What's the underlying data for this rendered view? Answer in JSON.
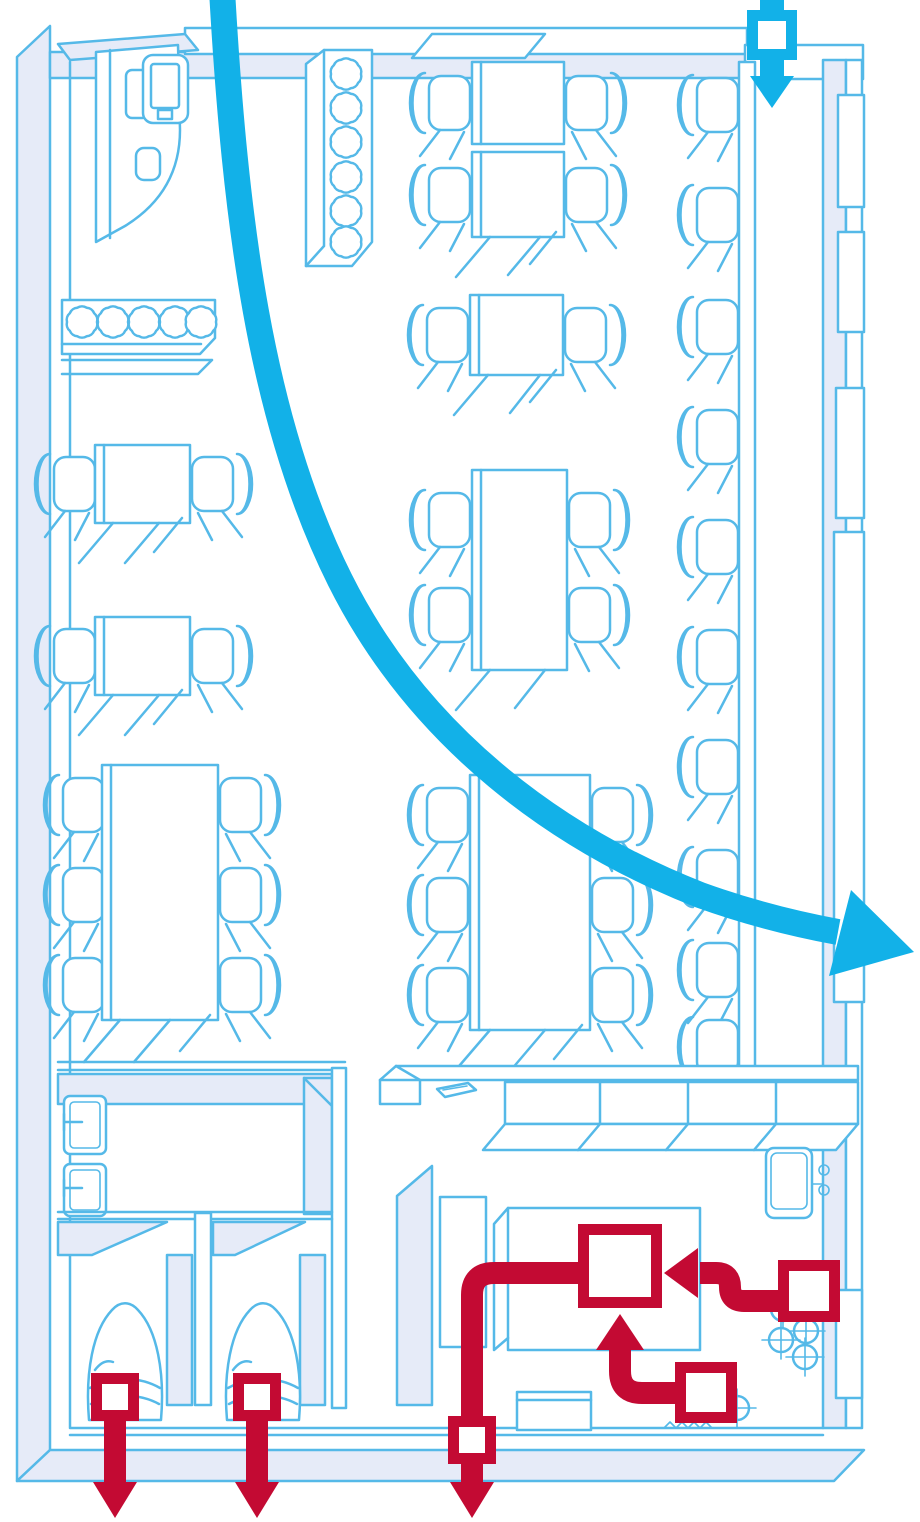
{
  "meta": {
    "title": "Isometric restaurant floor plan with entry arrow, evacuation routes and kitchen hazard marker",
    "text_content": "none — illustration only"
  },
  "colors": {
    "outline": "#55B9E8",
    "wall": "#E6EBF8",
    "flow": "#12B1E8",
    "alert": "#C30A33",
    "background": "#FFFFFF"
  },
  "legend": {
    "entry_marker": {
      "shape": "square with down arrow",
      "color_ref": "flow",
      "location": "top-right doorway"
    },
    "flow_arrow": {
      "shape": "thick curved arrow",
      "color_ref": "flow",
      "path": "from top edge curving down and right, exiting through right wall"
    },
    "hazard_marker": {
      "shape": "diagonally hatched square",
      "color_ref": "alert",
      "location": "kitchen appliance"
    },
    "exit_markers": [
      {
        "location": "left toilet stall",
        "direction": "down through bottom wall"
      },
      {
        "location": "right toilet stall",
        "direction": "down through bottom wall"
      },
      {
        "location": "kitchen corridor",
        "direction": "down through bottom wall"
      }
    ],
    "routes": [
      {
        "from": "kitchen station right",
        "to": "hazard square",
        "arrow": "left"
      },
      {
        "from": "kitchen station lower",
        "to": "hazard square",
        "arrow": "up"
      },
      {
        "from": "hazard square",
        "to": "bottom exit marker",
        "arrow": "down"
      }
    ]
  },
  "inventory": {
    "dining_tables": 8,
    "dining_chairs": 26,
    "bar_counter_stools": 10,
    "planters": 2,
    "planter_bushes": 11,
    "reception_register": 1,
    "washroom_sinks": 2,
    "toilet_stalls": 2,
    "kitchen_burners": 5,
    "kitchen_sink": 1
  }
}
